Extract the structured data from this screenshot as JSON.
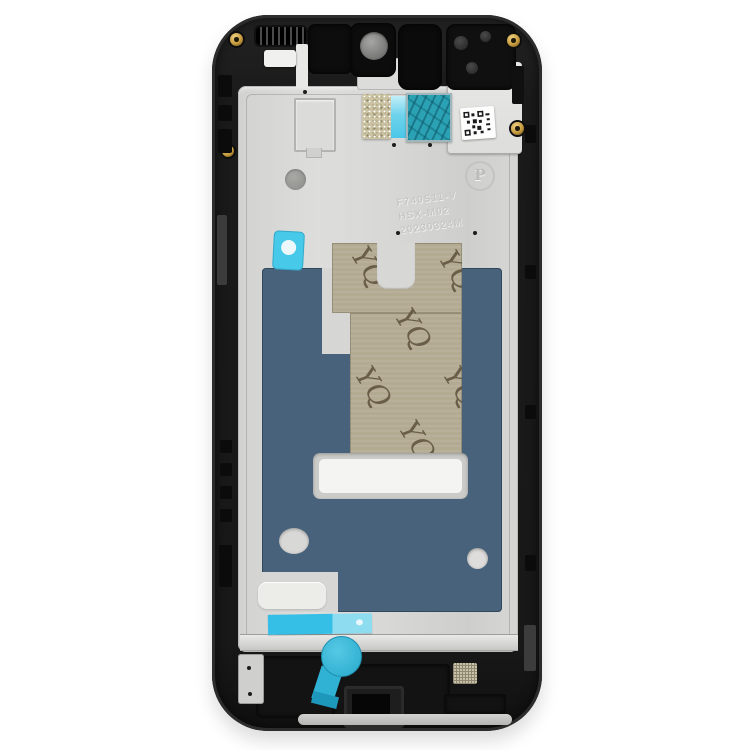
{
  "photo": {
    "subject": "Smartphone front housing LCD frame middle plate, black, inside view on white background"
  },
  "watermark": {
    "text": "YQ"
  },
  "etched": {
    "line1": "F740S11-V",
    "line2": "HSX-M02",
    "line3": "20230324M"
  },
  "emboss": {
    "letter_p": "P"
  },
  "colors": {
    "background": "#ffffff",
    "frame_black": "#1a1a1a",
    "plate_silver": "#d6d6d4",
    "adhesive_blue": "#47627a",
    "release_liner_tan": "#b3aa92",
    "tape_cyan": "#41c6e8",
    "pull_tab_teal": "#2fb2d4",
    "thermal_tape_teal": "#2aa2b4",
    "glitter_gold": "#cbc3a4",
    "screw_gold": "#c59a3d"
  }
}
